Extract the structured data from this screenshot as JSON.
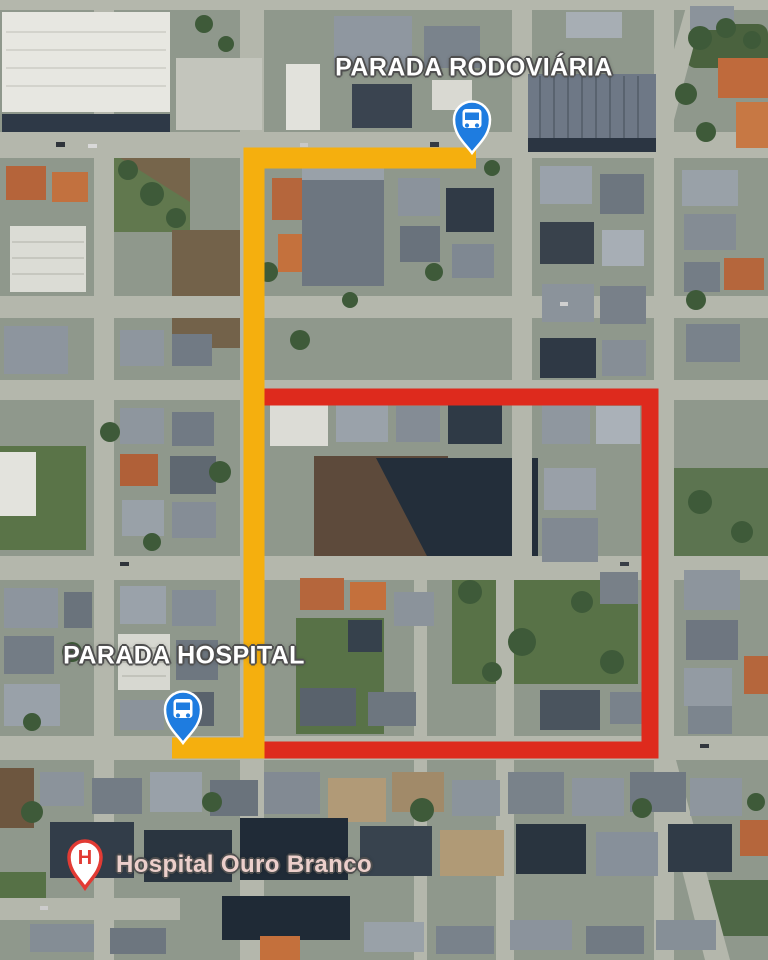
{
  "map": {
    "type": "satellite",
    "labels": {
      "rodoviaria": "PARADA RODOVIÁRIA",
      "hospital_stop": "PARADA HOSPITAL",
      "hospital_name": "Hospital Ouro Branco"
    },
    "markers": [
      {
        "id": "bus-stop-rodoviaria",
        "kind": "bus-stop"
      },
      {
        "id": "bus-stop-hospital",
        "kind": "bus-stop"
      },
      {
        "id": "hospital-ouro-branco",
        "kind": "hospital",
        "glyph": "H"
      }
    ],
    "routes": [
      {
        "id": "yellow-route"
      },
      {
        "id": "red-route"
      }
    ]
  },
  "theme": {
    "route_yellow": "#F5AF0E",
    "route_red": "#DE2A1D",
    "pin_blue": "#1E7CE0",
    "pin_border": "#FFFFFF",
    "hospital_red": "#E23B34",
    "label_text": "#FFFFFF",
    "label_outline": "#4F4F4F",
    "hospital_label_text": "#ECCFCB"
  }
}
